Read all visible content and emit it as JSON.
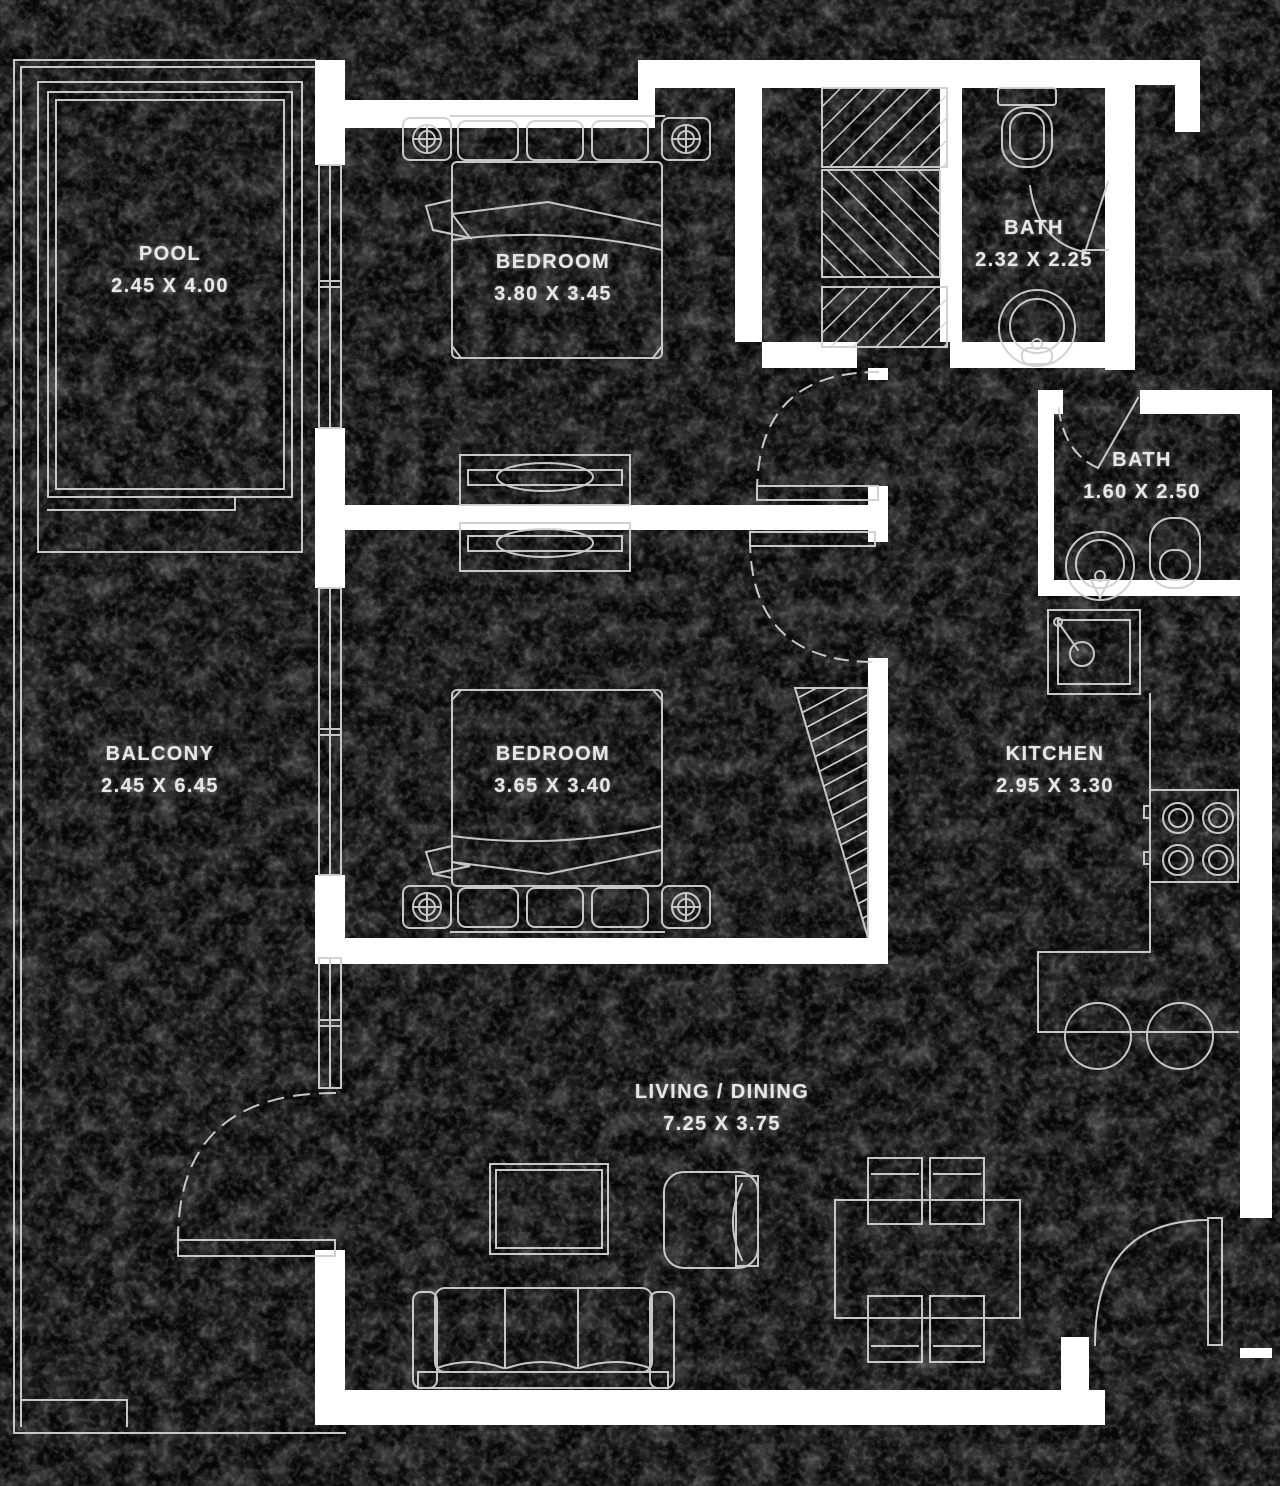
{
  "plan": {
    "title": "Apartment Floor Plan",
    "colors": {
      "background": "#060606",
      "line": "#d6d6d6",
      "wall": "#ffffff",
      "text": "#e6e6e6"
    },
    "rooms": [
      {
        "id": "pool",
        "name": "POOL",
        "dims": "2.45 X 4.00"
      },
      {
        "id": "bedroom1",
        "name": "BEDROOM",
        "dims": "3.80 X 3.45"
      },
      {
        "id": "bath1",
        "name": "BATH",
        "dims": "2.32 X 2.25"
      },
      {
        "id": "bath2",
        "name": "BATH",
        "dims": "1.60 X 2.50"
      },
      {
        "id": "balcony",
        "name": "BALCONY",
        "dims": "2.45 X 6.45"
      },
      {
        "id": "bedroom2",
        "name": "BEDROOM",
        "dims": "3.65 X 3.40"
      },
      {
        "id": "kitchen",
        "name": "KITCHEN",
        "dims": "2.95 X 3.30"
      },
      {
        "id": "living",
        "name": "LIVING / DINING",
        "dims": "7.25 X 3.75"
      }
    ],
    "furniture": [
      "double-bed",
      "nightstand-lamp",
      "dresser",
      "wardrobe-hatched",
      "toilet",
      "washbasin",
      "kitchen-sink",
      "stove-4-burner",
      "breakfast-counter",
      "bar-stool",
      "sofa-3-seat",
      "armchair",
      "coffee-table",
      "dining-table-4-chairs",
      "swing-door",
      "window",
      "pool-deck"
    ]
  }
}
